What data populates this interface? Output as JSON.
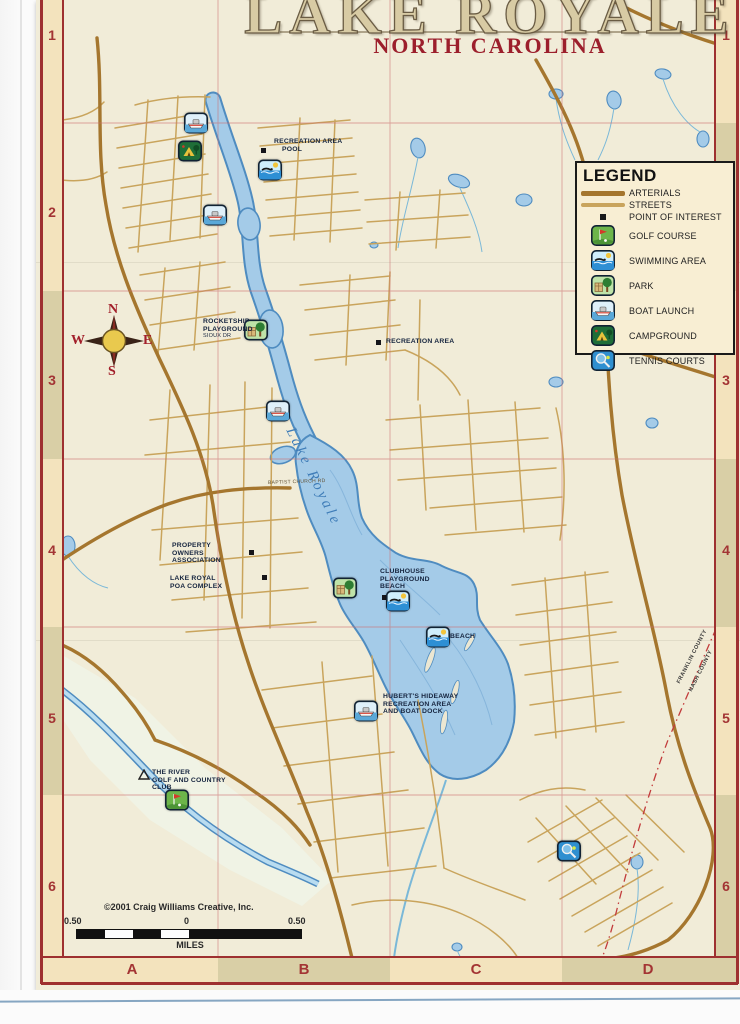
{
  "title": {
    "main": "LAKE ROYALE",
    "subtitle": "NORTH CAROLINA"
  },
  "legend": {
    "title": "LEGEND",
    "items": [
      {
        "label": "ARTERIALS"
      },
      {
        "label": "STREETS"
      },
      {
        "label": "POINT OF INTEREST"
      },
      {
        "label": "GOLF COURSE"
      },
      {
        "label": "SWIMMING AREA"
      },
      {
        "label": "PARK"
      },
      {
        "label": "BOAT LAUNCH"
      },
      {
        "label": "CAMPGROUND"
      },
      {
        "label": "TENNIS COURTS"
      }
    ]
  },
  "compass": {
    "n": "N",
    "e": "E",
    "s": "S",
    "w": "W"
  },
  "grid": {
    "rows": [
      "1",
      "2",
      "3",
      "4",
      "5",
      "6"
    ],
    "cols": [
      "A",
      "B",
      "C",
      "D"
    ]
  },
  "labels": {
    "recreation_pool_1": "RECREATION AREA",
    "recreation_pool_2": "POOL",
    "rocketship_1": "ROCKETSHIP",
    "rocketship_2": "PLAYGROUND",
    "rocketship_3": "SIOUX DR",
    "recreation_area": "RECREATION AREA",
    "property_1": "PROPERTY",
    "property_2": "OWNERS",
    "property_3": "ASSOCIATION",
    "poa_1": "LAKE ROYAL",
    "poa_2": "POA COMPLEX",
    "clubhouse_1": "CLUBHOUSE",
    "clubhouse_2": "PLAYGROUND",
    "clubhouse_3": "BEACH",
    "beach": "BEACH",
    "huberts_1": "HUBERT'S HIDEAWAY",
    "huberts_2": "RECREATION AREA",
    "huberts_3": "AND BOAT DOCK",
    "golf_1": "THE RIVER",
    "golf_2": "GOLF AND COUNTRY",
    "golf_3": "CLUB",
    "lake_name": "Lake Royale",
    "baptist_church_rd": "BAPTIST CHURCH RD",
    "county_top": "FRANKLIN COUNTY",
    "county_bottom": "NASH COUNTY"
  },
  "footer": {
    "copyright": "©2001 Craig Williams Creative, Inc.",
    "scale_left": "0.50",
    "scale_center": "0",
    "scale_right": "0.50",
    "scale_unit": "MILES"
  },
  "colors": {
    "arterial": "#a5762e",
    "street": "#c9a45c",
    "water_fill": "#a4cbe8",
    "water_edge": "#4f8cc0",
    "border_red": "#9e3030",
    "grid_pink": "#cc6f6f",
    "map_bg": "#f1ecd8",
    "label_navy": "#16253f",
    "red_text": "#a33434"
  }
}
